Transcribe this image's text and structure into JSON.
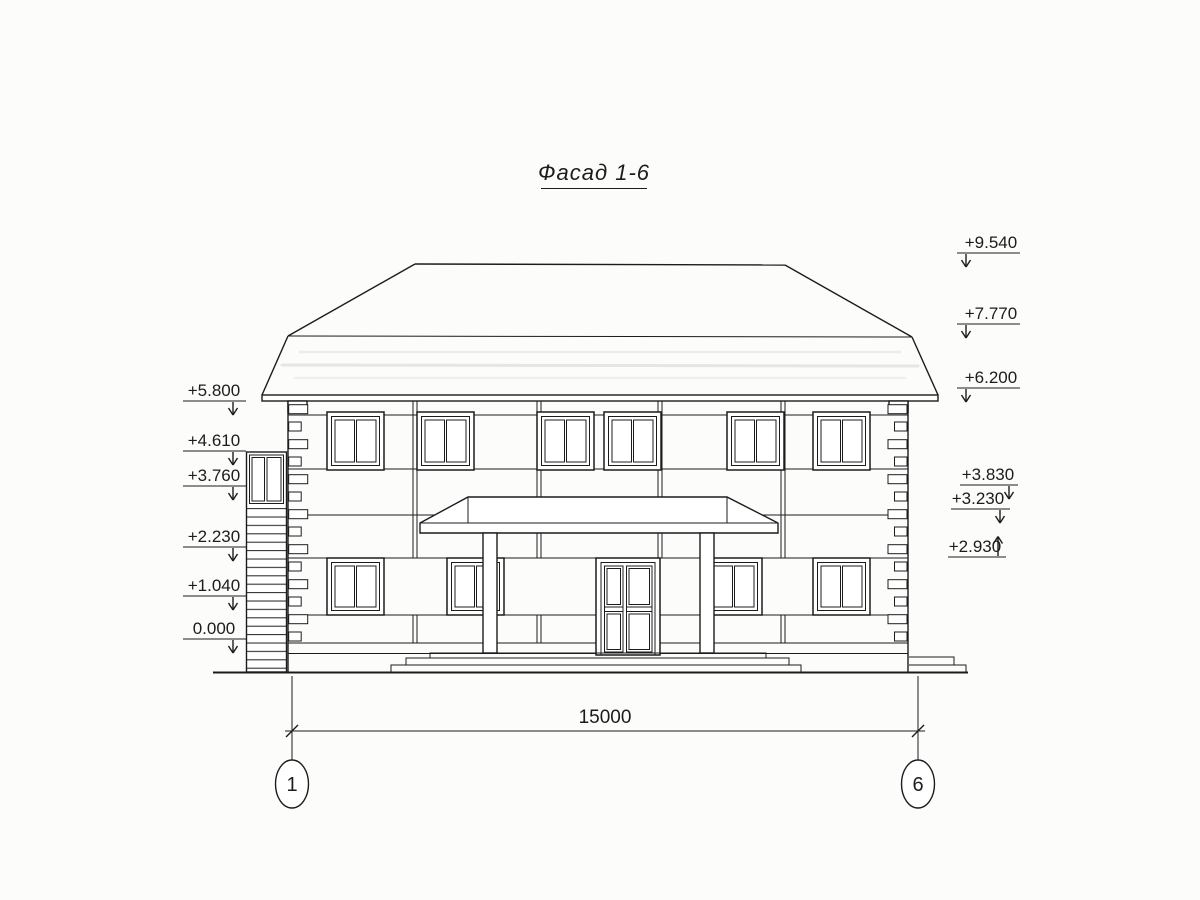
{
  "title": "Фасад 1-6",
  "elevation_marks": {
    "left": [
      {
        "label": "+5.800"
      },
      {
        "label": "+4.610"
      },
      {
        "label": "+3.760"
      },
      {
        "label": "+2.230"
      },
      {
        "label": "+1.040"
      },
      {
        "label": "0.000"
      }
    ],
    "right": [
      {
        "label": "+9.540"
      },
      {
        "label": "+7.770"
      },
      {
        "label": "+6.200"
      },
      {
        "label": "+3.830"
      },
      {
        "label": "+3.230"
      },
      {
        "label": "+2.930"
      }
    ]
  },
  "dimension": {
    "label": "15000"
  },
  "axes": {
    "left": {
      "label": "1"
    },
    "right": {
      "label": "6"
    }
  },
  "colors": {
    "line": "#1c1c1c",
    "background": "#fcfcfb"
  }
}
